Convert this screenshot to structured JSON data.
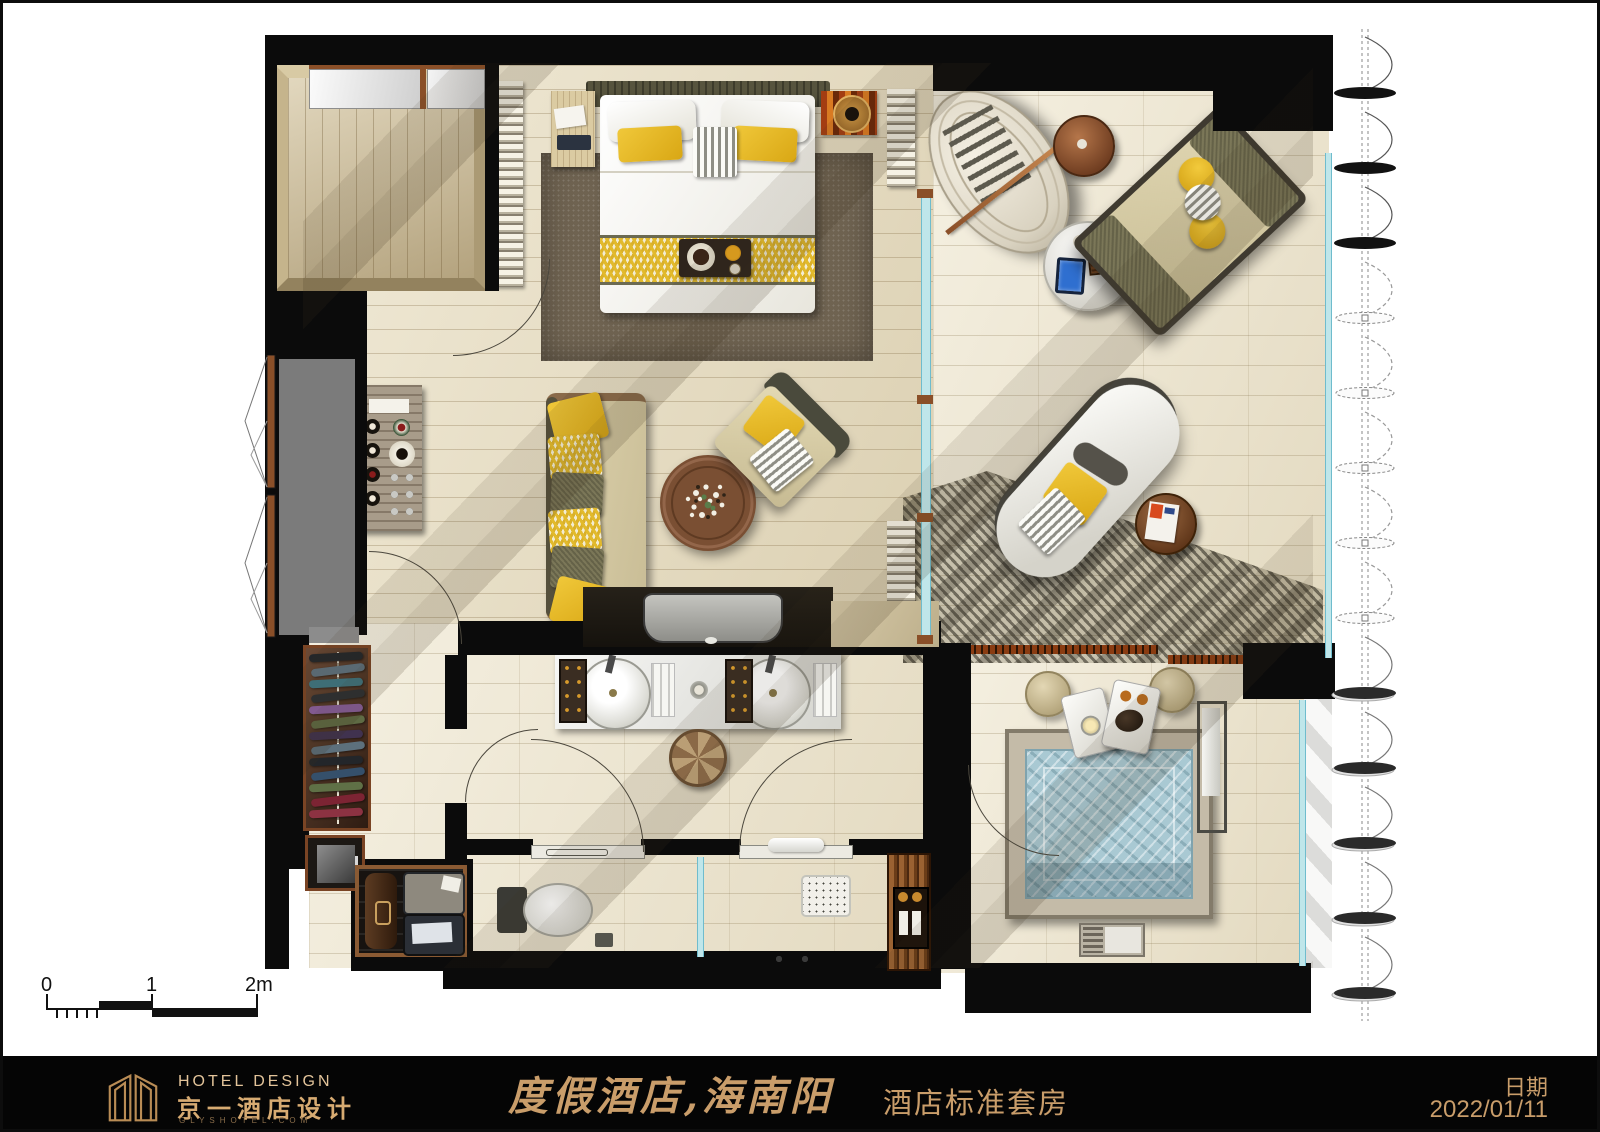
{
  "footer": {
    "logo": {
      "en": "HOTEL DESIGN",
      "zh": "京一酒店设计",
      "site": "GLYSHOTEL.COM"
    },
    "title_script": "度假酒店,海南阳光湾",
    "title_suffix": "酒店标准套房",
    "date_label": "日期",
    "date_value": "2022/01/11"
  },
  "scale_bar": {
    "t0": "0",
    "t1": "1",
    "t2": "2m"
  },
  "colors": {
    "accent_gold": "#cfa470",
    "wall_black": "#0b0b0b",
    "pillow_yellow": "#e2ba2c",
    "olive_cushion": "#7b7758",
    "water_blue": "#a9c9d3",
    "floor_wood": "#e9dfc2",
    "rug_brown": "#6f6351",
    "copper": "#9c5f3a"
  }
}
